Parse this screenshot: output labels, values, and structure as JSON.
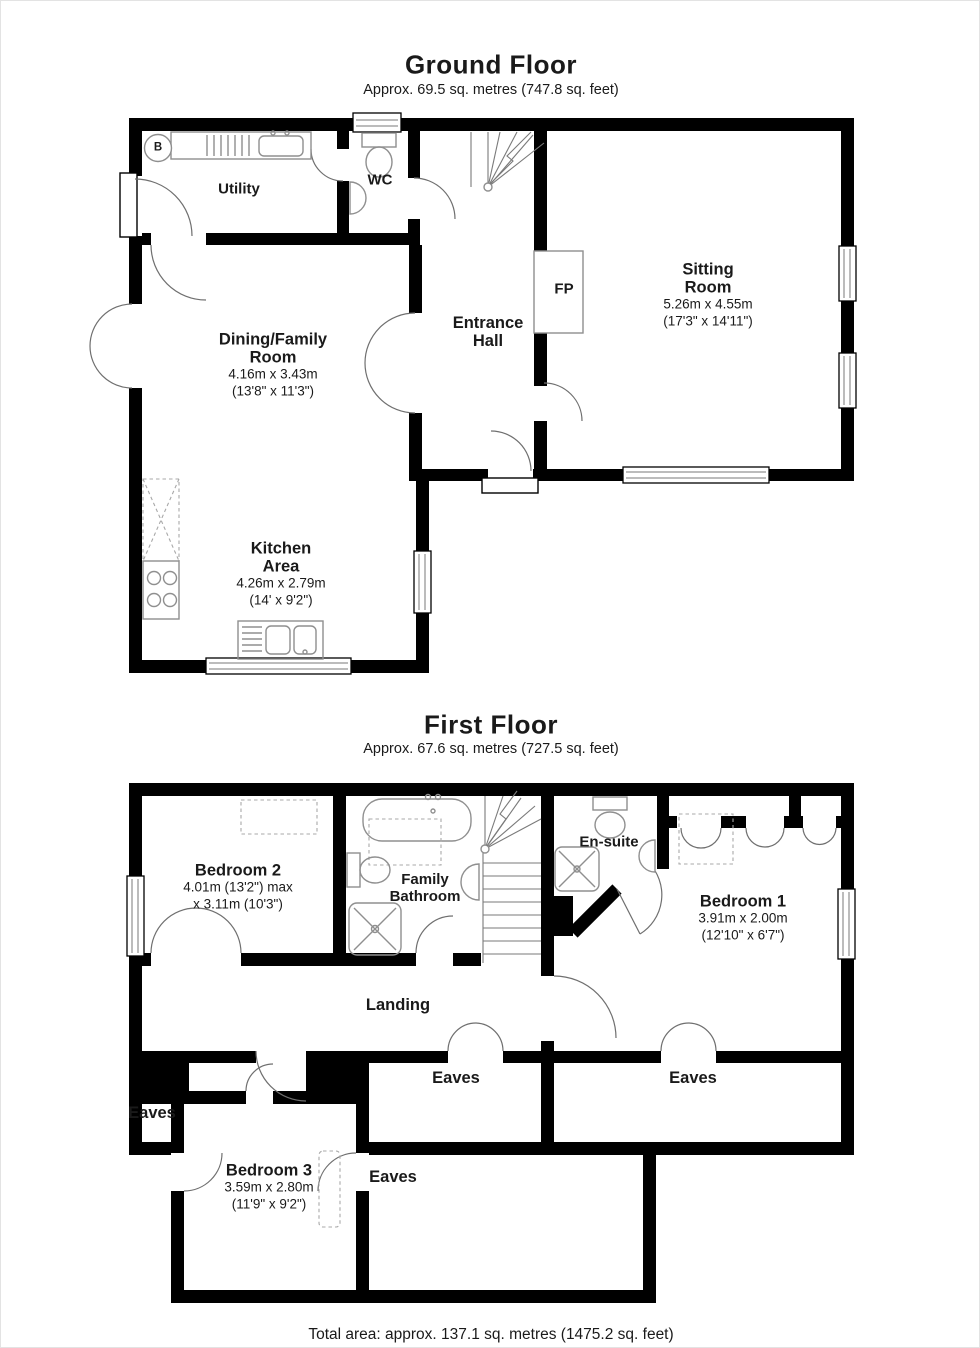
{
  "colors": {
    "wall": "#000000",
    "fixture": "#8f8f8f",
    "door_arc": "#6f6f6f",
    "text": "#1a1a1a"
  },
  "ground_floor": {
    "title": "Ground Floor",
    "subtitle": "Approx. 69.5 sq. metres (747.8 sq. feet)",
    "rooms": {
      "utility": {
        "name": "Utility"
      },
      "wc": {
        "name": "WC"
      },
      "entrance_hall": {
        "line1": "Entrance",
        "line2": "Hall"
      },
      "sitting_room": {
        "line1": "Sitting",
        "line2": "Room",
        "metric": "5.26m x 4.55m",
        "imperial": "(17'3\" x 14'11\")"
      },
      "dining_room": {
        "line1": "Dining/Family",
        "line2": "Room",
        "metric": "4.16m x 3.43m",
        "imperial": "(13'8\" x 11'3\")"
      },
      "kitchen": {
        "line1": "Kitchen",
        "line2": "Area",
        "metric": "4.26m x 2.79m",
        "imperial": "(14' x 9'2\")"
      }
    },
    "markers": {
      "fireplace": "FP",
      "boiler": "B"
    }
  },
  "first_floor": {
    "title": "First Floor",
    "subtitle": "Approx. 67.6 sq. metres (727.5 sq. feet)",
    "rooms": {
      "bedroom2": {
        "name": "Bedroom 2",
        "dims1": "4.01m (13'2\") max",
        "dims2": "x 3.11m (10'3\")"
      },
      "family_bathroom": {
        "line1": "Family",
        "line2": "Bathroom"
      },
      "ensuite": {
        "name": "En-suite"
      },
      "bedroom1": {
        "name": "Bedroom 1",
        "metric": "3.91m x 2.00m",
        "imperial": "(12'10\" x 6'7\")"
      },
      "landing": {
        "name": "Landing"
      },
      "bedroom3": {
        "name": "Bedroom 3",
        "metric": "3.59m x 2.80m",
        "imperial": "(11'9\" x 9'2\")"
      },
      "eaves_left": {
        "name": "Eaves"
      },
      "eaves_center": {
        "name": "Eaves"
      },
      "eaves_right": {
        "name": "Eaves"
      },
      "eaves_bottom": {
        "name": "Eaves"
      }
    }
  },
  "footer": {
    "total_area": "Total area: approx. 137.1 sq. metres (1475.2 sq. feet)"
  }
}
